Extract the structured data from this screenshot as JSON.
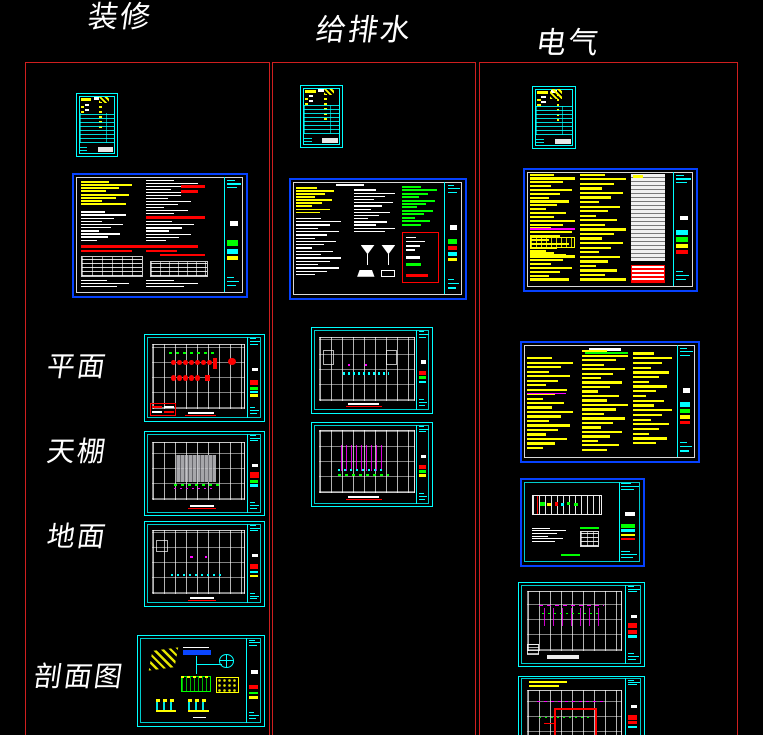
{
  "columns": [
    {
      "id": "decoration",
      "label": "装修"
    },
    {
      "id": "plumbing",
      "label": "给排水"
    },
    {
      "id": "electrical",
      "label": "电气"
    }
  ],
  "row_labels": [
    {
      "id": "plan",
      "label": "平面"
    },
    {
      "id": "ceiling",
      "label": "天棚"
    },
    {
      "id": "floor",
      "label": "地面"
    },
    {
      "id": "section",
      "label": "剖面图"
    }
  ],
  "palette": {
    "background": "#000000",
    "frame_red": "#cf1f1f",
    "cad_red": "#ff0000",
    "cad_yellow": "#ffff00",
    "cad_green": "#00ff00",
    "cad_cyan": "#00ffff",
    "cad_blue": "#0a46ff",
    "cad_magenta": "#ff00ff",
    "cad_white": "#ffffff"
  }
}
